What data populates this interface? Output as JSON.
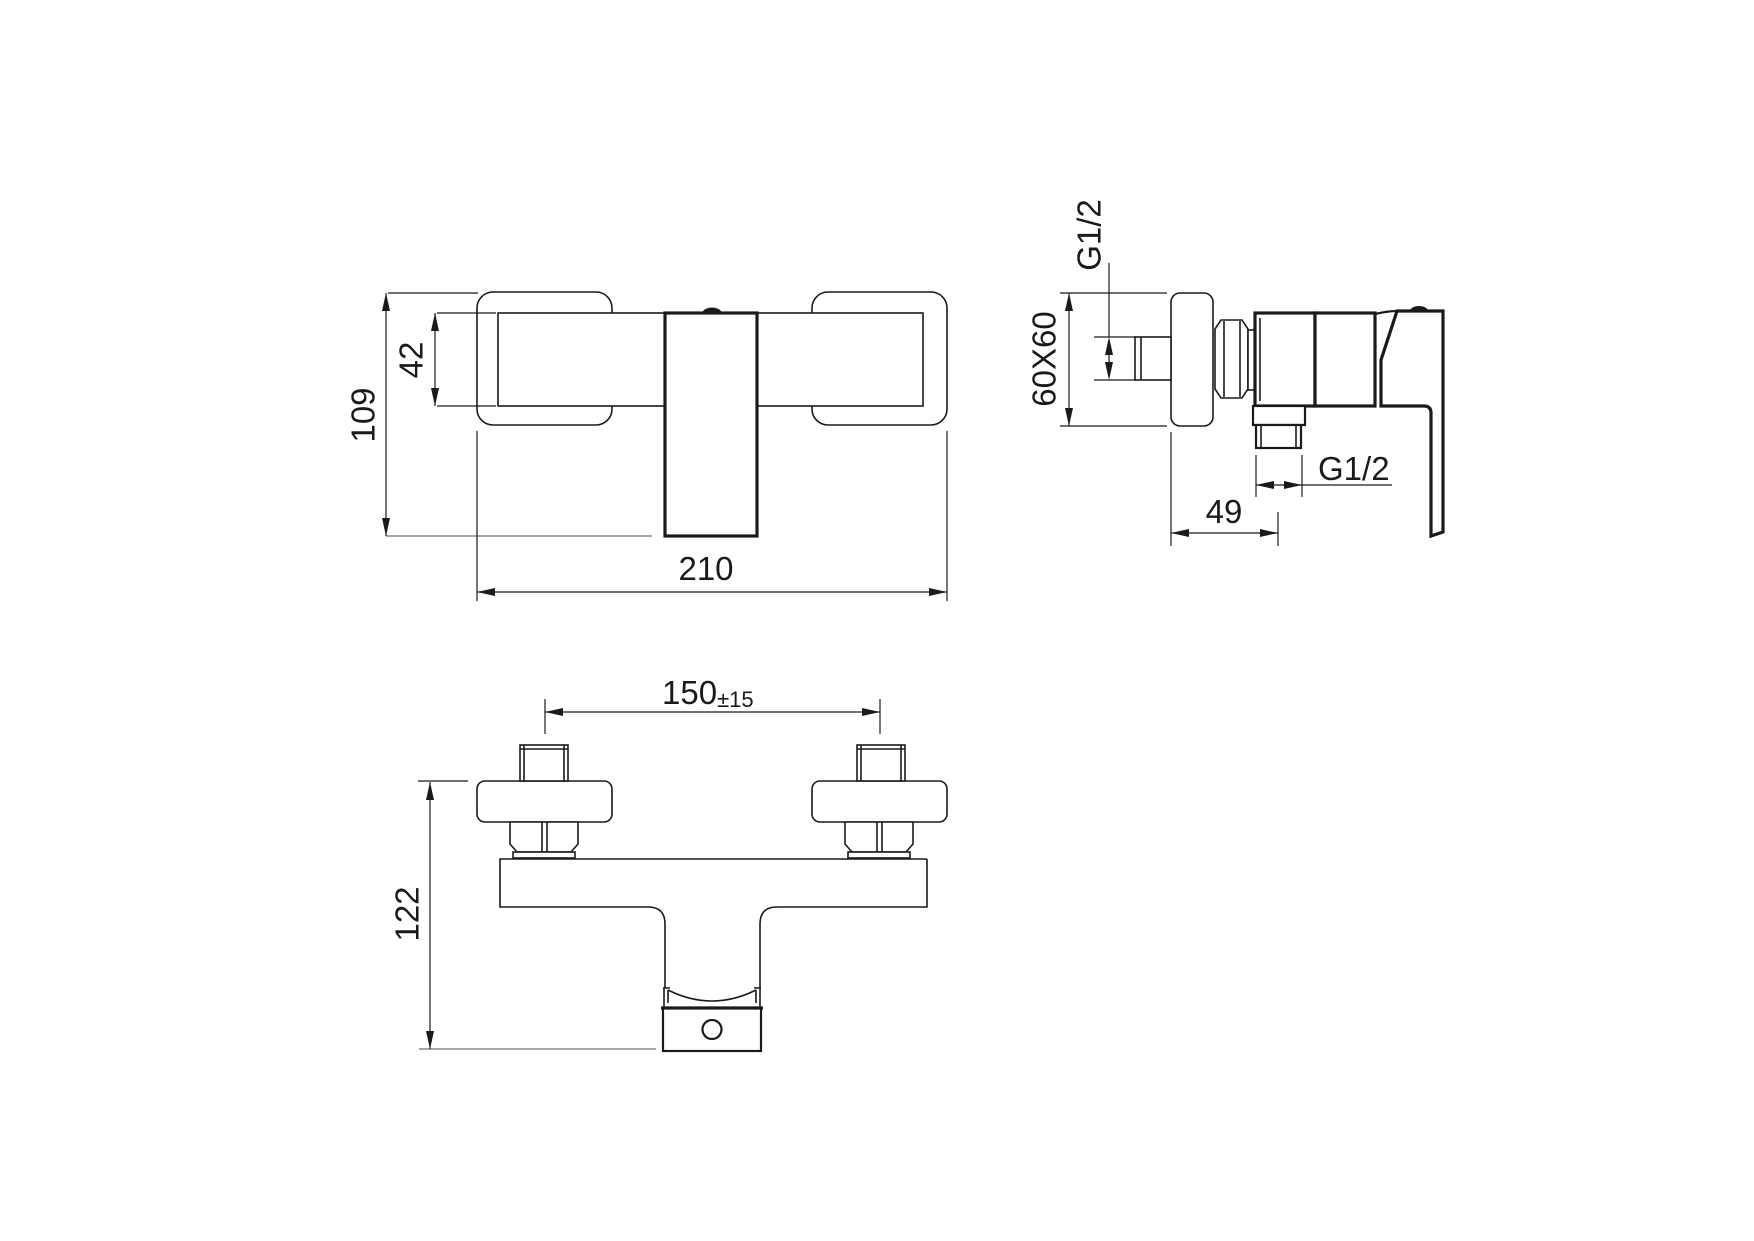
{
  "drawing": {
    "background": "#ffffff",
    "line_color": "#1a1a1a",
    "aux_line_color": "#8c8c8c",
    "views": {
      "front": {
        "height": "109",
        "bar_height": "42",
        "width": "210"
      },
      "side": {
        "wall_thread": "G1/2",
        "flange_size": "60X60",
        "outlet_thread": "G1/2",
        "wall_to_outlet_center": "49"
      },
      "bottom": {
        "hole_centers": "150",
        "hole_centers_tolerance": "±15",
        "depth": "122"
      }
    }
  }
}
